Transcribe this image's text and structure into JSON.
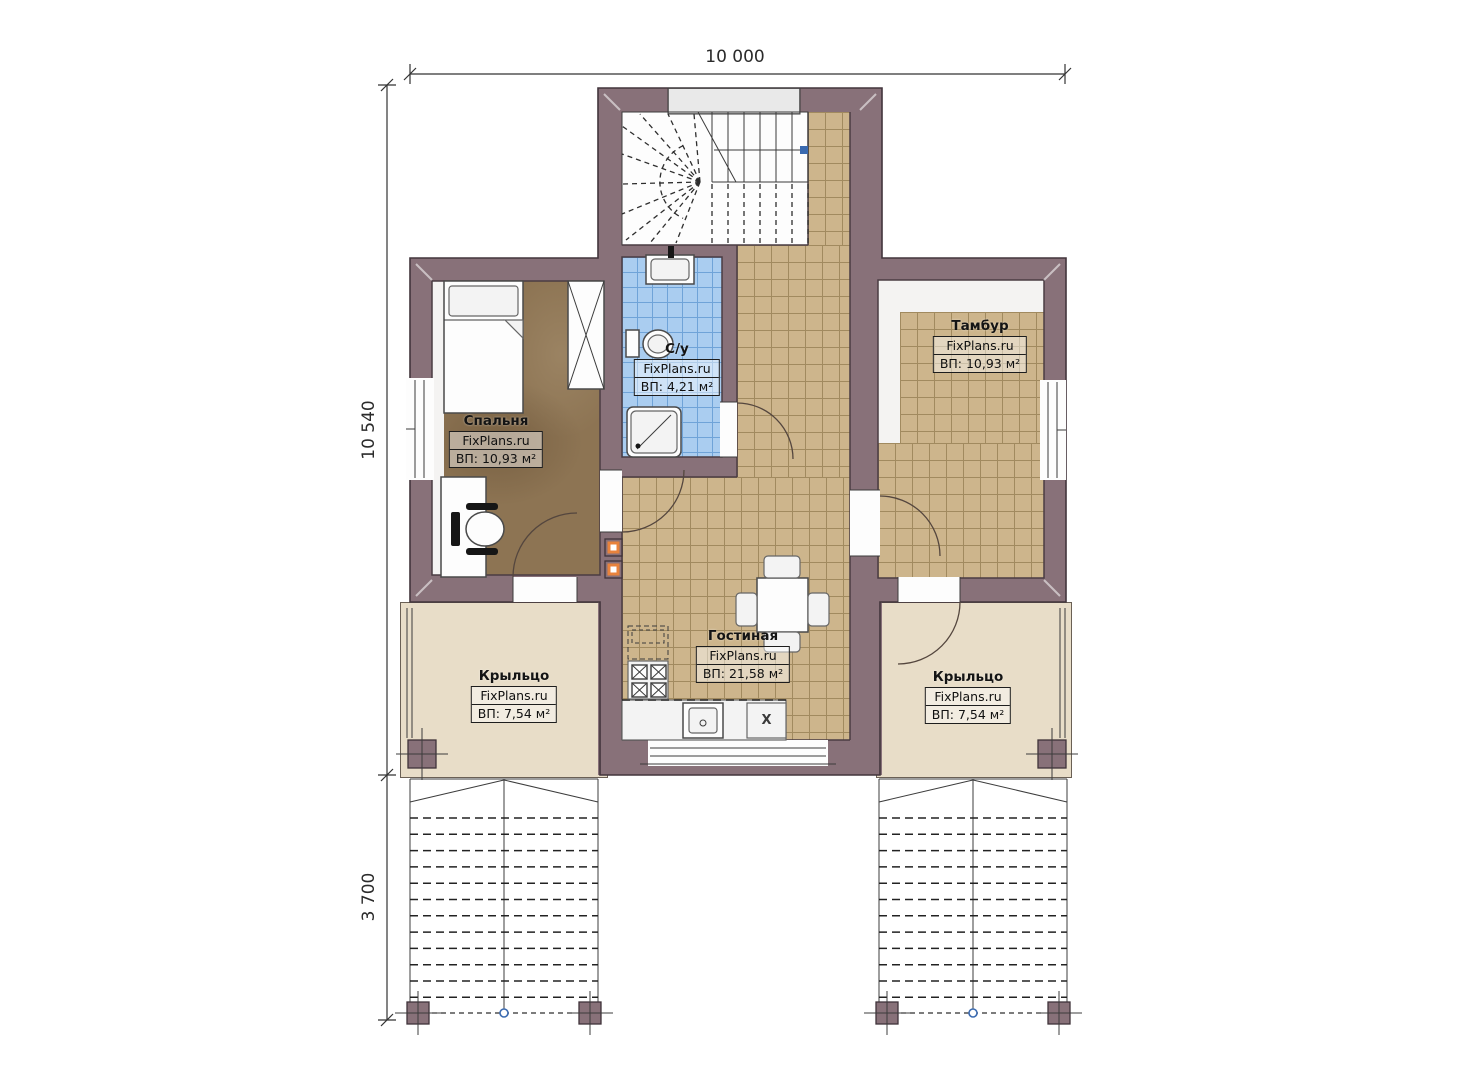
{
  "brand": "FixPlans.ru",
  "dimensions": {
    "width_top": "10 000",
    "height_main": "10 540",
    "stairs_depth": "3 700"
  },
  "rooms": {
    "bedroom": {
      "name": "Спальня",
      "brand": "FixPlans.ru",
      "area": "ВП: 10,93 м²"
    },
    "bathroom": {
      "name": "С/у",
      "brand": "FixPlans.ru",
      "area": "ВП: 4,21 м²"
    },
    "tambour": {
      "name": "Тамбур",
      "brand": "FixPlans.ru",
      "area": "ВП: 10,93 м²"
    },
    "living": {
      "name": "Гостиная",
      "brand": "FixPlans.ru",
      "area": "ВП: 21,58 м²"
    },
    "porch_left": {
      "name": "Крыльцо",
      "brand": "FixPlans.ru",
      "area": "ВП: 7,54 м²"
    },
    "porch_right": {
      "name": "Крыльцо",
      "brand": "FixPlans.ru",
      "area": "ВП: 7,54 м²"
    }
  },
  "kitchen": {
    "hob_label": "X"
  },
  "colors": {
    "wall": "#887179",
    "wall-outline": "#42353c",
    "tile": "#cdb58c",
    "tile-line": "#a18a5f",
    "bath": "#aacdf0",
    "bath-line": "#6fa3d8",
    "bedroom-floor": "#8d7453",
    "porch": "#e8ddc8",
    "landing": "#e9e9e9",
    "accent-orange": "#e8823c",
    "marker-blue": "#3a6ab0"
  }
}
